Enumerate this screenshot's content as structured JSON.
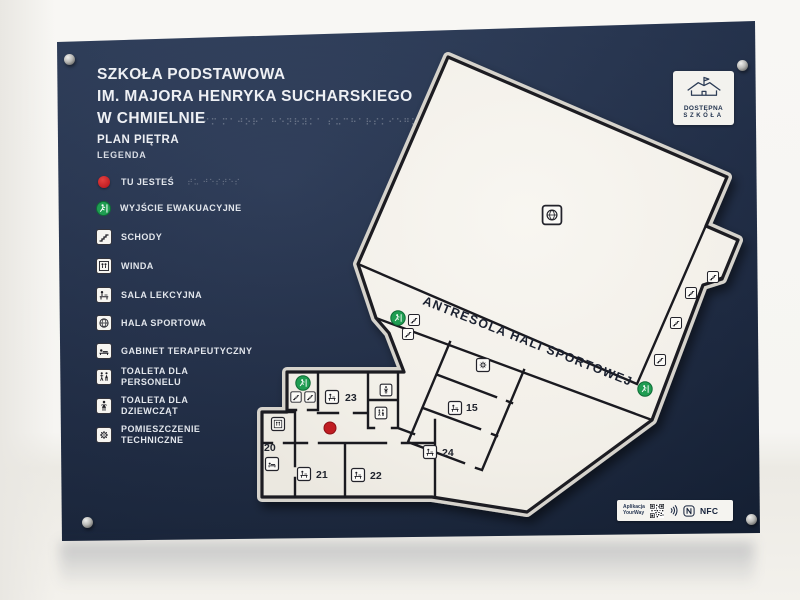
{
  "header": {
    "title_line1": "SZKOŁA PODSTAWOWA",
    "title_line2": "IM. MAJORA HENRYKA SUCHARSKIEGO",
    "title_line3": "W CHMIELNIE",
    "braille_row": "⠊⠍ ⠍⠁⠚⠕⠗⠁ ⠓⠑⠝⠗⠽⠅⠁ ⠎⠥⠉⠓⠁⠗⠎⠅⠊⠑⠛⠕",
    "plan_label": "PLAN PIĘTRA",
    "legend_label": "LEGENDA"
  },
  "legend": {
    "items": [
      {
        "icon": "you-are-here-icon",
        "line1": "TU JESTEŚ",
        "line2": "",
        "braille": "⠞⠥ ⠚⠑⠎⠞⠑⠎"
      },
      {
        "icon": "emergency-exit-icon",
        "line1": "WYJŚCIE EWAKUACYJNE",
        "line2": "",
        "braille": "⠺⠽⠚⠎⠉⠊⠑"
      },
      {
        "icon": "stairs-icon",
        "line1": "SCHODY",
        "line2": "",
        "braille": "⠎⠉⠓⠕⠙⠽"
      },
      {
        "icon": "elevator-icon",
        "line1": "WINDA",
        "line2": "",
        "braille": "⠺⠊⠝⠙⠁"
      },
      {
        "icon": "classroom-icon",
        "line1": "SALA LEKCYJNA",
        "line2": "",
        "braille": "⠎⠁⠇⠁"
      },
      {
        "icon": "sports-hall-icon",
        "line1": "HALA SPORTOWA",
        "line2": "",
        "braille": "⠓⠁⠇⠁"
      },
      {
        "icon": "therapy-room-icon",
        "line1": "GABINET TERAPEUTYCZNY",
        "line2": "",
        "braille": "⠛⠁⠃"
      },
      {
        "icon": "toilet-staff-icon",
        "line1": "TOALETA DLA",
        "line2": "PERSONELU",
        "braille": "⠞⠕⠁"
      },
      {
        "icon": "toilet-girls-icon",
        "line1": "TOALETA DLA",
        "line2": "DZIEWCZĄT",
        "braille": "⠞⠕⠁"
      },
      {
        "icon": "technical-room-icon",
        "line1": "POMIESZCZENIE",
        "line2": "TECHNICZNE",
        "braille": "⠏⠕⠍"
      }
    ]
  },
  "map": {
    "corridor_label": "ANTRESOLA HALI SPORTOWEJ",
    "rooms": {
      "r20": "20",
      "r21": "21",
      "r22": "22",
      "r23": "23",
      "r24": "24",
      "r15": "15"
    }
  },
  "logo": {
    "line1": "DOSTĘPNA",
    "line2": "SZKOŁA"
  },
  "footer": {
    "app_line1": "Aplikacja",
    "app_line2": "YourWay",
    "nfc_label": "NFC"
  },
  "colors": {
    "board_navy": "#1e2c48",
    "plan_fill": "#f3f1ea",
    "wall": "#1a1a20",
    "accent_green": "#1f9d52",
    "accent_red": "#c01d22",
    "acrylic_edge": "#d6d3cc"
  }
}
